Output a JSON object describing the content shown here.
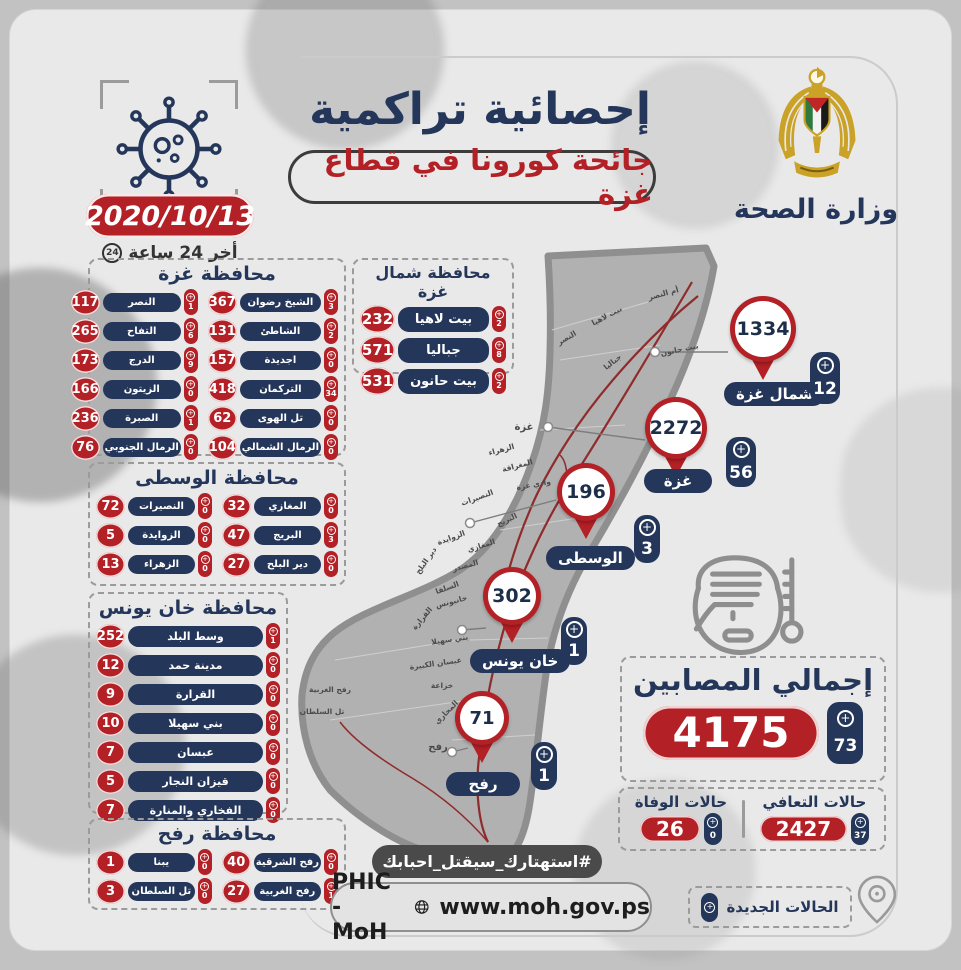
{
  "header": {
    "title": "إحصائية تراكمية",
    "subtitle": "جائحة كورونا في قطاع غزة",
    "date": "2020/10/13",
    "last24": "أخر 24 ساعة",
    "clock": "24",
    "ministry": "وزارة الصحة"
  },
  "sections": [
    {
      "id": "gaza",
      "title": "محافظة غزة",
      "items": [
        {
          "name": "الشيخ رضوان",
          "total": "367",
          "new": "3"
        },
        {
          "name": "النصر",
          "total": "117",
          "new": "1"
        },
        {
          "name": "الشاطئ",
          "total": "131",
          "new": "2"
        },
        {
          "name": "التفاح",
          "total": "265",
          "new": "6"
        },
        {
          "name": "اجديدة",
          "total": "157",
          "new": "0"
        },
        {
          "name": "الدرج",
          "total": "173",
          "new": "9"
        },
        {
          "name": "التركمان",
          "total": "418",
          "new": "34"
        },
        {
          "name": "الزيتون",
          "total": "166",
          "new": "0"
        },
        {
          "name": "تل الهوى",
          "total": "62",
          "new": "0"
        },
        {
          "name": "الصبرة",
          "total": "236",
          "new": "1"
        },
        {
          "name": "الرمال الشمالي",
          "total": "104",
          "new": "0"
        },
        {
          "name": "الرمال الجنوبي",
          "total": "76",
          "new": "0"
        }
      ]
    },
    {
      "id": "north",
      "title": "محافظة شمال غزة",
      "items": [
        {
          "name": "بيت لاهيا",
          "total": "232",
          "new": "2"
        },
        {
          "name": "جباليا",
          "total": "571",
          "new": "8"
        },
        {
          "name": "بيت حانون",
          "total": "531",
          "new": "2"
        }
      ]
    },
    {
      "id": "wusta",
      "title": "محافظة الوسطى",
      "items": [
        {
          "name": "المغازي",
          "total": "32",
          "new": "0"
        },
        {
          "name": "النصيرات",
          "total": "72",
          "new": "0"
        },
        {
          "name": "البريج",
          "total": "47",
          "new": "3"
        },
        {
          "name": "الزوايدة",
          "total": "5",
          "new": "0"
        },
        {
          "name": "دير البلح",
          "total": "27",
          "new": "0"
        },
        {
          "name": "الزهراء",
          "total": "13",
          "new": "0"
        }
      ]
    },
    {
      "id": "khan",
      "title": "محافظة خان يونس",
      "items": [
        {
          "name": "وسط البلد",
          "total": "252",
          "new": "1"
        },
        {
          "name": "مدينة حمد",
          "total": "12",
          "new": "0"
        },
        {
          "name": "القرارة",
          "total": "9",
          "new": "0"
        },
        {
          "name": "بني سهيلا",
          "total": "10",
          "new": "0"
        },
        {
          "name": "عبسان",
          "total": "7",
          "new": "0"
        },
        {
          "name": "قيزان النجار",
          "total": "5",
          "new": "0"
        },
        {
          "name": "الفخاري والمنارة",
          "total": "7",
          "new": "0"
        }
      ]
    },
    {
      "id": "rafah",
      "title": "محافظة رفح",
      "items": [
        {
          "name": "رفح الشرقية",
          "total": "40",
          "new": "0"
        },
        {
          "name": "يبنا",
          "total": "1",
          "new": "0"
        },
        {
          "name": "رفح الغربية",
          "total": "27",
          "new": "1"
        },
        {
          "name": "تل السلطان",
          "total": "3",
          "new": "0"
        }
      ]
    }
  ],
  "pins": [
    {
      "region": "شمال غزة",
      "total": "1334",
      "new": "12"
    },
    {
      "region": "غزة",
      "total": "2272",
      "new": "56"
    },
    {
      "region": "الوسطى",
      "total": "196",
      "new": "3"
    },
    {
      "region": "خان يونس",
      "total": "302",
      "new": "1"
    },
    {
      "region": "رفح",
      "total": "71",
      "new": "1"
    }
  ],
  "totals": {
    "infected_label": "إجمالي المصابين",
    "infected_total": "4175",
    "infected_new": "73",
    "recovered_label": "حالات التعافي",
    "recovered_total": "2427",
    "recovered_new": "37",
    "deaths_label": "حالات الوفاة",
    "deaths_total": "26",
    "deaths_new": "0"
  },
  "footer": {
    "hashtag": "#استهتارك_سيقتل_احبابك",
    "org": "PHIC - MoH",
    "website": "www.moh.gov.ps",
    "legend": "الحالات الجديدة"
  },
  "map": {
    "labels": [
      {
        "t": "أم النصر",
        "x": 664,
        "y": 296,
        "r": -15
      },
      {
        "t": "بيت لاهيا",
        "x": 608,
        "y": 318,
        "r": -28
      },
      {
        "t": "بيت حانون",
        "x": 680,
        "y": 352,
        "r": -12
      },
      {
        "t": "جباليا",
        "x": 614,
        "y": 364,
        "r": -38
      },
      {
        "t": "النصر",
        "x": 568,
        "y": 340,
        "r": -30
      },
      {
        "t": "غزة",
        "x": 524,
        "y": 430,
        "r": 0,
        "s": 10
      },
      {
        "t": "الزهراء",
        "x": 502,
        "y": 452,
        "r": -15
      },
      {
        "t": "المغراقة",
        "x": 518,
        "y": 468,
        "r": -15
      },
      {
        "t": "وادي غزة",
        "x": 534,
        "y": 487,
        "r": -10
      },
      {
        "t": "النصيرات",
        "x": 478,
        "y": 500,
        "r": -20
      },
      {
        "t": "البريج",
        "x": 508,
        "y": 522,
        "r": -25
      },
      {
        "t": "الزوايدة",
        "x": 452,
        "y": 540,
        "r": -20
      },
      {
        "t": "المغازي",
        "x": 482,
        "y": 548,
        "r": -18
      },
      {
        "t": "المصدر",
        "x": 466,
        "y": 568,
        "r": -15
      },
      {
        "t": "دير البلح",
        "x": 428,
        "y": 562,
        "r": -55
      },
      {
        "t": "السلقا",
        "x": 448,
        "y": 590,
        "r": -20
      },
      {
        "t": "القرارة",
        "x": 424,
        "y": 620,
        "r": -50
      },
      {
        "t": "خانيونس",
        "x": 452,
        "y": 604,
        "r": -15
      },
      {
        "t": "بني سهيلا",
        "x": 450,
        "y": 642,
        "r": -8
      },
      {
        "t": "عبسان الكبيرة",
        "x": 436,
        "y": 666,
        "r": -8
      },
      {
        "t": "خزاعة",
        "x": 442,
        "y": 688,
        "r": 0
      },
      {
        "t": "رفح الغربية",
        "x": 330,
        "y": 692,
        "r": 0
      },
      {
        "t": "تل السلطان",
        "x": 322,
        "y": 714,
        "r": 0
      },
      {
        "t": "المحاري",
        "x": 448,
        "y": 714,
        "r": -45
      },
      {
        "t": "البيوك",
        "x": 474,
        "y": 718,
        "r": 0
      },
      {
        "t": "رفح",
        "x": 438,
        "y": 750,
        "r": 0,
        "s": 10
      },
      {
        "t": "الشوكة",
        "x": 488,
        "y": 790,
        "r": 0
      }
    ]
  }
}
